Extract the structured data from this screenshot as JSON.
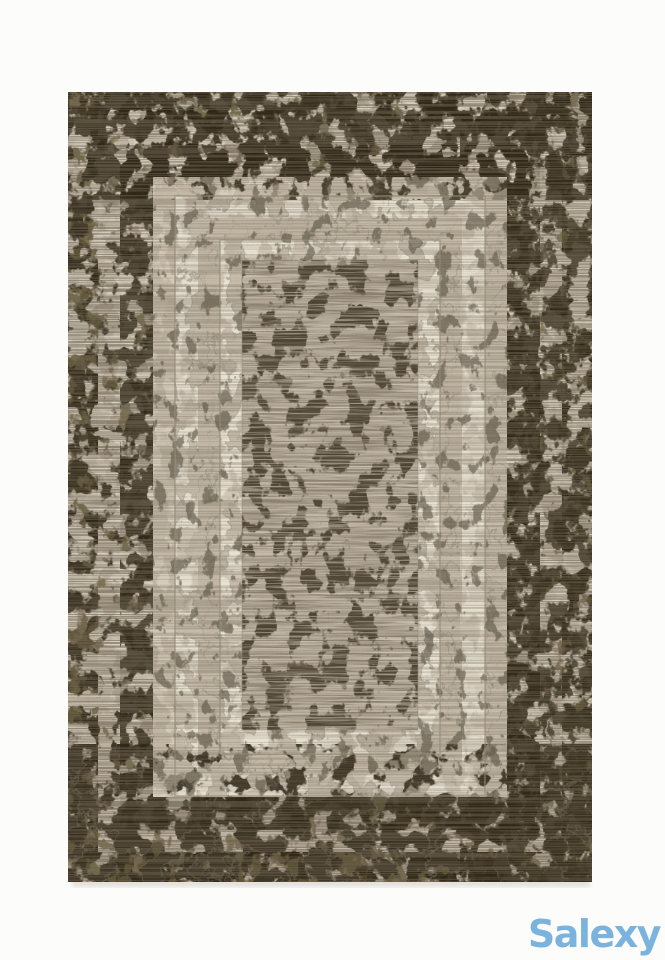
{
  "watermark": {
    "label": "Salexy"
  },
  "photo": {
    "alt": "Beige and cream area rug with nested rectangular border frames, distressed dark olive-brown mottled pattern and plain striated center field"
  },
  "colors": {
    "page-bg": "#fcfcfb",
    "watermark": "#7ab3de",
    "rug-outer-base": "#b4a998",
    "rug-ribbed": "#c2b7a6",
    "rug-darkring-base": "#afa493",
    "rug-beige": "#c6bbaa",
    "rug-cream-a": "#e8e2d3",
    "rug-cream-b": "#ece6d7",
    "rug-field": "#c1b6a5",
    "rug-dark": "#2e2717",
    "rug-olive": "#6b5d3e",
    "rug-cream-patch": "#ddd4c4",
    "rug-dark-speck": "#57503f",
    "rug-streak-dark": "#7b7060",
    "rug-streak-light": "#d9d0c1",
    "rug-weave": "#6e6352",
    "rug-line": "#968b77",
    "shadow": "#d9d6cf"
  }
}
